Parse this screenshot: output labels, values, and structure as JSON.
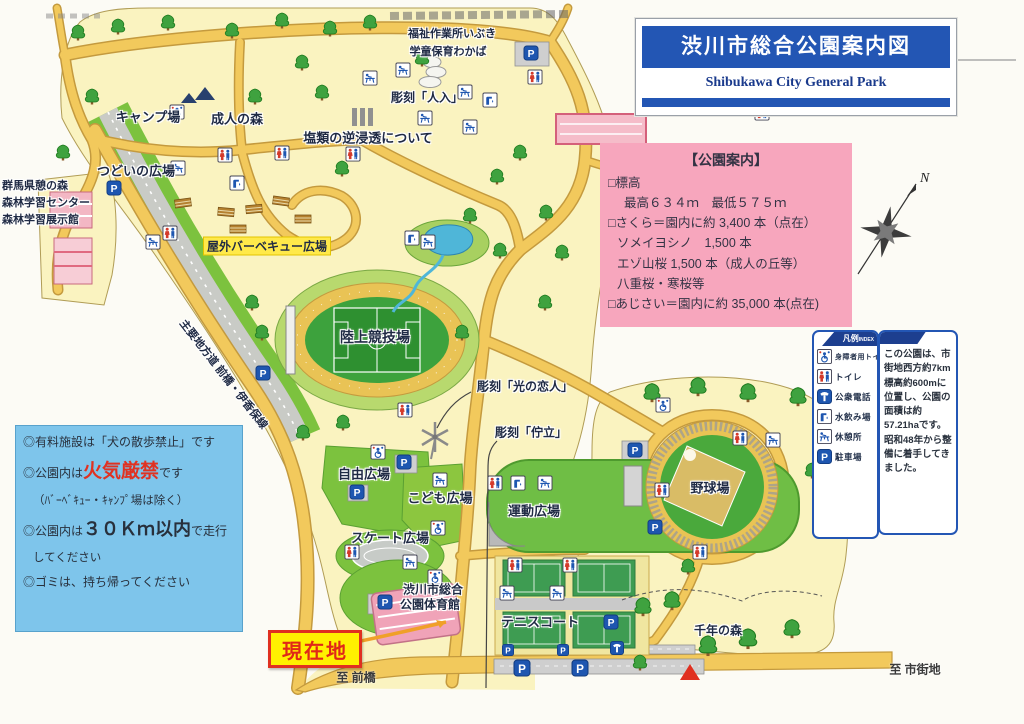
{
  "colors": {
    "band_blue": "#2356b4",
    "subtitle_navy": "#1a3a8c",
    "info_pink": "#f7a6bd",
    "rules_blue": "#7ec5eb",
    "warning_red": "#e03222",
    "current_red": "#e02818",
    "current_yellow": "#fff100",
    "icon_blue": "#1e56b0",
    "road_yellow": "#f2c95c",
    "park_cream": "#faf3c0",
    "field_green": "#6fbe45",
    "highlight_yellow": "#ffe94a"
  },
  "title_box": {
    "title": "渋川市総合公園案内図",
    "subtitle": "Shibukawa City General Park"
  },
  "park_info_box": {
    "heading": "【公園案内】",
    "lines": [
      {
        "text": "□標高"
      },
      {
        "text": "最高６３４ｍ　最低５７５ｍ"
      },
      {
        "text": "□さくら＝園内に約 3,400 本（点在）"
      },
      {
        "text": "ソメイヨシノ　1,500 本"
      },
      {
        "text": "エゾ山桜 1,500 本（成人の丘等）"
      },
      {
        "text": "八重桜・寒桜等"
      },
      {
        "text": "□あじさい＝園内に約 35,000 本(点在)"
      }
    ]
  },
  "rules_box": {
    "line1": "◎有料施設は「犬の散歩禁止」です",
    "line2_pre": "◎公園内は",
    "line2_em": "火気厳禁",
    "line2_post": "です",
    "line3": "（ﾊﾞｰﾍﾞｷｭｰ・ｷｬﾝﾌﾟ場は除く）",
    "line4_pre": "◎公園内は",
    "line4_em": "３０Ｋｍ以内",
    "line4_post": "で走行",
    "line5": "してください",
    "line6": "◎ゴミは、持ち帰ってください"
  },
  "legend_box": {
    "heading": "凡例",
    "heading_sub": "INDEX",
    "items": [
      {
        "id": "accessible",
        "label": "身障者用トイレ"
      },
      {
        "id": "toilet",
        "label": "トイレ"
      },
      {
        "id": "phone",
        "label": "公衆電話"
      },
      {
        "id": "fountain",
        "label": "水飲み場"
      },
      {
        "id": "rest",
        "label": "休憩所"
      },
      {
        "id": "parking",
        "label": "駐車場"
      }
    ]
  },
  "description_box": {
    "text": "この公園は、市街地西方約7km標高約600mに位置し、公園の面積は約57.21haです。昭和48年から整備に着手してきました。"
  },
  "map": {
    "compass_label": "N",
    "current_location": {
      "label": "現在地"
    },
    "labels": [
      {
        "id": "camp",
        "text": "キャンプ場",
        "x": 148,
        "y": 116,
        "size": 13
      },
      {
        "id": "seijin-forest",
        "text": "成人の森",
        "x": 237,
        "y": 118,
        "size": 13
      },
      {
        "id": "tsudoi-plaza",
        "text": "つどいの広場",
        "x": 136,
        "y": 170,
        "size": 13
      },
      {
        "id": "gunma-ikoi-forest",
        "text": "群馬県憩の森",
        "x": 2,
        "y": 185,
        "size": 11,
        "style": "left"
      },
      {
        "id": "forest-learning-center",
        "text": "森林学習センター",
        "x": 2,
        "y": 202,
        "size": 11,
        "style": "left"
      },
      {
        "id": "forest-exhibit-hall",
        "text": "森林学習展示館",
        "x": 2,
        "y": 219,
        "size": 11,
        "style": "left"
      },
      {
        "id": "fukushi-ibuki",
        "text": "福祉作業所いぶき",
        "x": 452,
        "y": 33,
        "size": 11
      },
      {
        "id": "gakudo-wakaba",
        "text": "学童保育わかば",
        "x": 448,
        "y": 51,
        "size": 11
      },
      {
        "id": "sculpture-enrui",
        "text": "塩類の逆浸透について",
        "x": 368,
        "y": 137,
        "size": 13
      },
      {
        "id": "sculpture-jinnyu",
        "text": "彫刻「人入」",
        "x": 427,
        "y": 97,
        "size": 12
      },
      {
        "id": "bbq-plaza",
        "text": "屋外バーベキュー広場",
        "x": 267,
        "y": 246,
        "size": 12,
        "style": "highlight"
      },
      {
        "id": "athletics-stadium",
        "text": "陸上競技場",
        "x": 375,
        "y": 337,
        "size": 14
      },
      {
        "id": "route-maebashi-ikaho",
        "text": "主要地方道 前橋・伊香保線",
        "x": 224,
        "y": 374,
        "size": 11,
        "rotate": 52
      },
      {
        "id": "sculpture-hikari",
        "text": "彫刻「光の恋人」",
        "x": 525,
        "y": 386,
        "size": 12
      },
      {
        "id": "sculpture-choritsu",
        "text": "彫刻「佇立」",
        "x": 531,
        "y": 432,
        "size": 12
      },
      {
        "id": "jiyu-plaza",
        "text": "自由広場",
        "x": 364,
        "y": 473,
        "size": 13
      },
      {
        "id": "kodomo-plaza",
        "text": "こども広場",
        "x": 440,
        "y": 497,
        "size": 13
      },
      {
        "id": "undo-plaza",
        "text": "運動広場",
        "x": 534,
        "y": 510,
        "size": 13
      },
      {
        "id": "skate-plaza",
        "text": "スケート広場",
        "x": 390,
        "y": 537,
        "size": 13
      },
      {
        "id": "gym-name-1",
        "text": "渋川市総合",
        "x": 433,
        "y": 589,
        "size": 12
      },
      {
        "id": "gym-name-2",
        "text": "公園体育館",
        "x": 430,
        "y": 604,
        "size": 12
      },
      {
        "id": "tennis-court",
        "text": "テニスコート",
        "x": 540,
        "y": 621,
        "size": 13
      },
      {
        "id": "baseball-field",
        "text": "野球場",
        "x": 710,
        "y": 487,
        "size": 13
      },
      {
        "id": "sennen-forest",
        "text": "千年の森",
        "x": 718,
        "y": 630,
        "size": 12
      },
      {
        "id": "to-maebashi",
        "text": "至 前橋",
        "x": 356,
        "y": 677,
        "size": 12,
        "style": "plain"
      },
      {
        "id": "to-shigaichi",
        "text": "至 市街地",
        "x": 915,
        "y": 669,
        "size": 12,
        "style": "plain"
      }
    ],
    "icons": [
      {
        "t": "parking",
        "x": 531,
        "y": 53
      },
      {
        "t": "parking",
        "x": 114,
        "y": 188
      },
      {
        "t": "parking",
        "x": 263,
        "y": 373
      },
      {
        "t": "parking",
        "x": 404,
        "y": 462
      },
      {
        "t": "parking",
        "x": 357,
        "y": 492
      },
      {
        "t": "parking",
        "x": 385,
        "y": 602
      },
      {
        "t": "parking",
        "x": 635,
        "y": 450
      },
      {
        "t": "parking",
        "x": 655,
        "y": 527
      },
      {
        "t": "parking",
        "x": 611,
        "y": 622
      },
      {
        "t": "parking",
        "x": 508,
        "y": 650,
        "s": 12
      },
      {
        "t": "parking",
        "x": 563,
        "y": 650,
        "s": 12
      },
      {
        "t": "parking",
        "x": 522,
        "y": 668,
        "s": 17
      },
      {
        "t": "parking",
        "x": 580,
        "y": 668,
        "s": 17
      },
      {
        "t": "toilet",
        "x": 225,
        "y": 155
      },
      {
        "t": "toilet",
        "x": 282,
        "y": 153
      },
      {
        "t": "toilet",
        "x": 353,
        "y": 154
      },
      {
        "t": "toilet",
        "x": 535,
        "y": 77
      },
      {
        "t": "toilet",
        "x": 762,
        "y": 113
      },
      {
        "t": "toilet",
        "x": 170,
        "y": 233
      },
      {
        "t": "toilet",
        "x": 405,
        "y": 410
      },
      {
        "t": "toilet",
        "x": 495,
        "y": 483
      },
      {
        "t": "toilet",
        "x": 515,
        "y": 565
      },
      {
        "t": "toilet",
        "x": 570,
        "y": 565
      },
      {
        "t": "toilet",
        "x": 662,
        "y": 490
      },
      {
        "t": "toilet",
        "x": 740,
        "y": 438
      },
      {
        "t": "toilet",
        "x": 700,
        "y": 552
      },
      {
        "t": "toilet",
        "x": 352,
        "y": 552
      },
      {
        "t": "accessible",
        "x": 177,
        "y": 112
      },
      {
        "t": "accessible",
        "x": 378,
        "y": 452
      },
      {
        "t": "accessible",
        "x": 438,
        "y": 528
      },
      {
        "t": "accessible",
        "x": 663,
        "y": 405
      },
      {
        "t": "accessible",
        "x": 435,
        "y": 577
      },
      {
        "t": "rest",
        "x": 178,
        "y": 168
      },
      {
        "t": "rest",
        "x": 153,
        "y": 242
      },
      {
        "t": "rest",
        "x": 370,
        "y": 78
      },
      {
        "t": "rest",
        "x": 403,
        "y": 70
      },
      {
        "t": "rest",
        "x": 465,
        "y": 92
      },
      {
        "t": "rest",
        "x": 425,
        "y": 118
      },
      {
        "t": "rest",
        "x": 470,
        "y": 127
      },
      {
        "t": "rest",
        "x": 428,
        "y": 242
      },
      {
        "t": "rest",
        "x": 440,
        "y": 480
      },
      {
        "t": "rest",
        "x": 545,
        "y": 483
      },
      {
        "t": "rest",
        "x": 410,
        "y": 562
      },
      {
        "t": "rest",
        "x": 507,
        "y": 593
      },
      {
        "t": "rest",
        "x": 557,
        "y": 593
      },
      {
        "t": "rest",
        "x": 773,
        "y": 440
      },
      {
        "t": "fountain",
        "x": 237,
        "y": 183
      },
      {
        "t": "fountain",
        "x": 490,
        "y": 100
      },
      {
        "t": "fountain",
        "x": 412,
        "y": 238
      },
      {
        "t": "fountain",
        "x": 518,
        "y": 483
      },
      {
        "t": "phone",
        "x": 617,
        "y": 648,
        "s": 14
      }
    ]
  }
}
